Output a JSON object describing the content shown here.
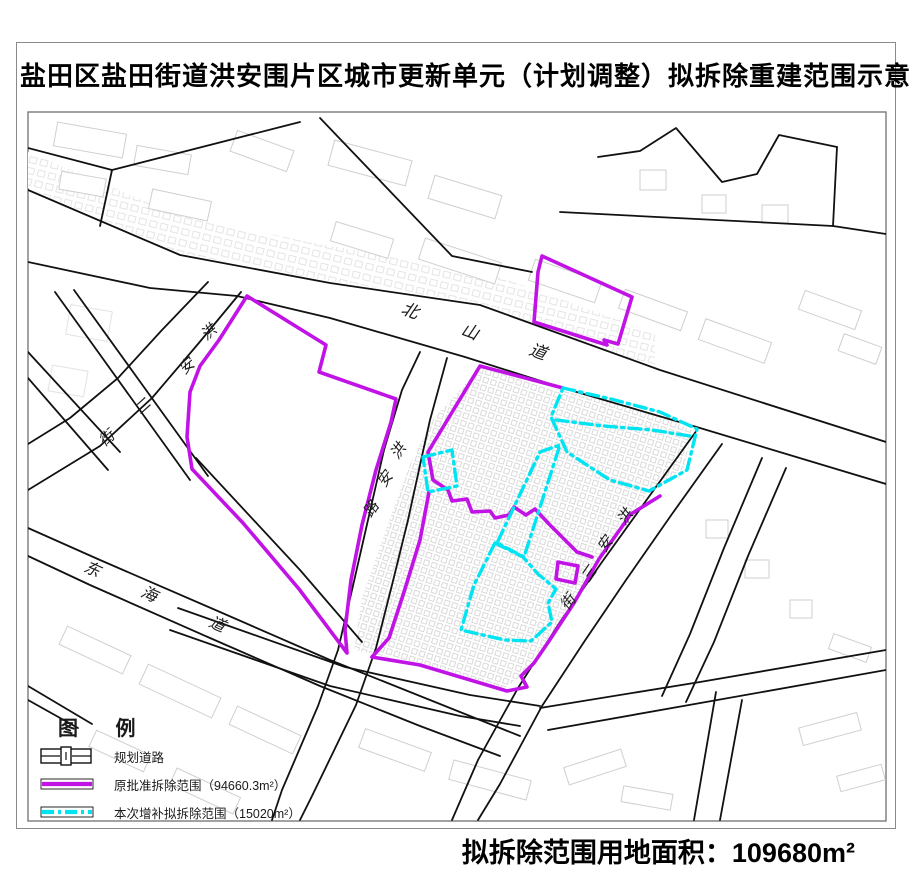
{
  "title": "盐田区盐田街道洪安围片区城市更新单元（计划调整）拟拆除重建范围示意图",
  "footer": {
    "area_text": "拟拆除范围用地面积：109680m²"
  },
  "legend": {
    "title": "图  例",
    "items": [
      {
        "symbol": "planned-road",
        "label": "规划道路"
      },
      {
        "symbol": "original-approved-boundary",
        "label": "原批准拆除范围（94660.3m²）",
        "color": "#c113e6"
      },
      {
        "symbol": "supplementary-boundary",
        "label": "本次增补拟拆除范围（15020m²）",
        "color": "#00e4f2"
      }
    ]
  },
  "map": {
    "colors": {
      "original_boundary": "#c113e6",
      "supplementary_boundary": "#00e4f2",
      "roads": "#111111",
      "buildings": "#cfcfcf"
    },
    "road_labels": [
      {
        "name": "北山道",
        "size": 17,
        "rot": 20,
        "chars": [
          {
            "c": "北",
            "x": 408,
            "y": 316
          },
          {
            "c": "山",
            "x": 468,
            "y": 337
          },
          {
            "c": "道",
            "x": 536,
            "y": 357
          }
        ]
      },
      {
        "name": "洪安二街",
        "size": 15,
        "rot": -42,
        "chars": [
          {
            "c": "洪",
            "x": 212,
            "y": 336
          },
          {
            "c": "安",
            "x": 190,
            "y": 370
          },
          {
            "c": "二",
            "x": 146,
            "y": 410
          },
          {
            "c": "街",
            "x": 110,
            "y": 442
          }
        ]
      },
      {
        "name": "洪安路",
        "size": 15,
        "rot": -55,
        "chars": [
          {
            "c": "洪",
            "x": 402,
            "y": 454
          },
          {
            "c": "安",
            "x": 389,
            "y": 482
          },
          {
            "c": "路",
            "x": 375,
            "y": 512
          }
        ]
      },
      {
        "name": "洪安三街",
        "size": 15,
        "rot": -55,
        "chars": [
          {
            "c": "洪",
            "x": 629,
            "y": 520
          },
          {
            "c": "安",
            "x": 609,
            "y": 547
          },
          {
            "c": "三",
            "x": 593,
            "y": 577
          },
          {
            "c": "街",
            "x": 572,
            "y": 605
          }
        ]
      },
      {
        "name": "东海道",
        "size": 16,
        "rot": 24,
        "chars": [
          {
            "c": "东",
            "x": 90,
            "y": 574
          },
          {
            "c": "海",
            "x": 147,
            "y": 599
          },
          {
            "c": "道",
            "x": 215,
            "y": 629
          }
        ]
      }
    ]
  }
}
